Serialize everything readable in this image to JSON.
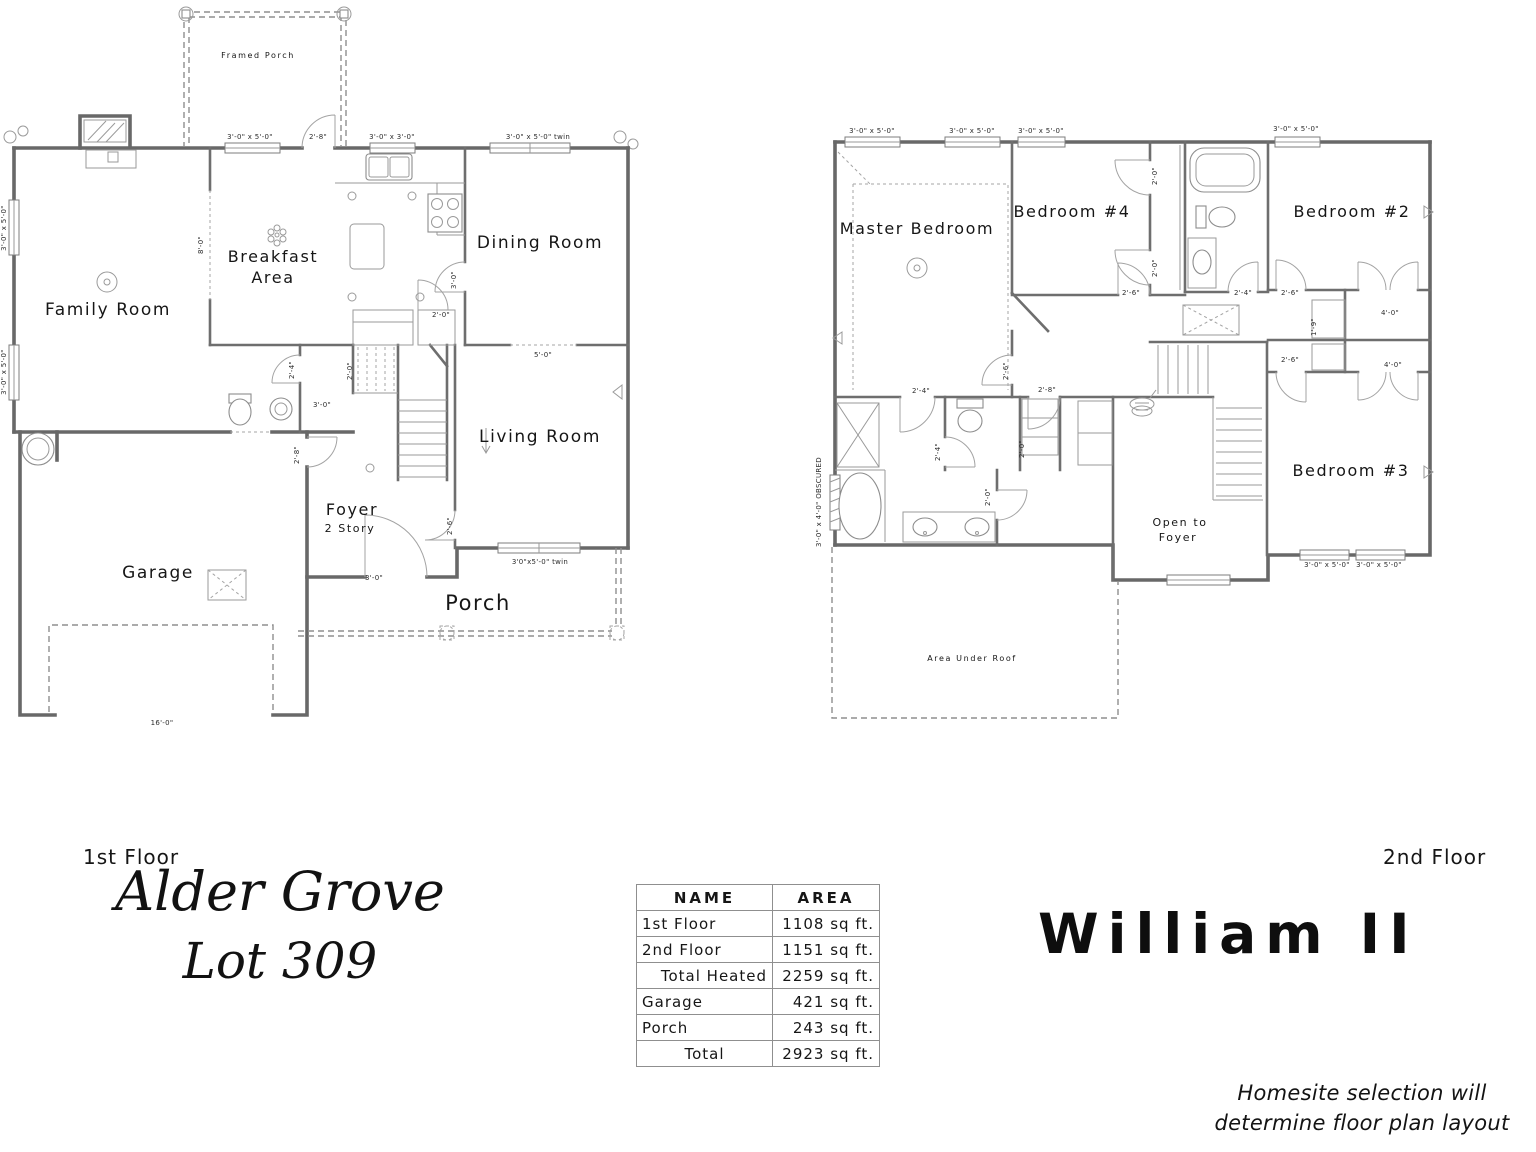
{
  "titles": {
    "first_floor_label": "1st Floor",
    "second_floor_label": "2nd Floor",
    "community_name": "Alder Grove",
    "lot_number": "Lot 309",
    "plan_name": "William II",
    "disclaimer_line1": "Homesite selection will",
    "disclaimer_line2": "determine floor plan layout"
  },
  "colors": {
    "wall": "#686868",
    "text": "#161616",
    "background": "#ffffff"
  },
  "area_table": {
    "name_header": "NAME",
    "area_header": "AREA",
    "rows": [
      {
        "name": "1st Floor",
        "area": "1108 sq ft."
      },
      {
        "name": "2nd Floor",
        "area": "1151 sq ft."
      },
      {
        "name": "Total Heated",
        "area": "2259 sq ft."
      },
      {
        "name": "Garage",
        "area": "421 sq ft."
      },
      {
        "name": "Porch",
        "area": "243 sq ft."
      },
      {
        "name": "Total",
        "area": "2923 sq ft."
      }
    ]
  },
  "floor1": {
    "rooms": {
      "family": "Family Room",
      "breakfast1": "Breakfast",
      "breakfast2": "Area",
      "dining": "Dining Room",
      "living": "Living Room",
      "foyer": "Foyer",
      "foyer_sub": "2 Story",
      "garage": "Garage",
      "porch": "Porch",
      "framed_porch": "Framed Porch"
    },
    "dims": [
      {
        "t": "3'-0\" x 5'-0\"",
        "x": 250,
        "y": 139
      },
      {
        "t": "2'-8\"",
        "x": 318,
        "y": 139
      },
      {
        "t": "3'-0\" x 3'-0\"",
        "x": 392,
        "y": 139
      },
      {
        "t": "3'-0\" x 5'-0\" twin",
        "x": 538,
        "y": 139
      },
      {
        "t": "3'-0\" x 5'-0\"",
        "x": 6,
        "y": 228,
        "r": -90
      },
      {
        "t": "3'-0\" x 5'-0\"",
        "x": 6,
        "y": 372,
        "r": -90
      },
      {
        "t": "8'-0\"",
        "x": 203,
        "y": 245,
        "r": -90
      },
      {
        "t": "2'-4\"",
        "x": 294,
        "y": 370,
        "r": -90
      },
      {
        "t": "3'-0\"",
        "x": 322,
        "y": 407
      },
      {
        "t": "2'-0\"",
        "x": 352,
        "y": 371,
        "r": -90
      },
      {
        "t": "3'-0\"",
        "x": 456,
        "y": 280,
        "r": -90
      },
      {
        "t": "2'-0\"",
        "x": 441,
        "y": 317
      },
      {
        "t": "5'-0\"",
        "x": 543,
        "y": 357
      },
      {
        "t": "2'-8\"",
        "x": 299,
        "y": 455,
        "r": -90
      },
      {
        "t": "2'-6\"",
        "x": 452,
        "y": 526,
        "r": -90
      },
      {
        "t": "3'-0\"",
        "x": 374,
        "y": 580
      },
      {
        "t": "3'0\"x5'-0\" twin",
        "x": 540,
        "y": 564
      },
      {
        "t": "16'-0\"",
        "x": 162,
        "y": 725
      }
    ]
  },
  "floor2": {
    "rooms": {
      "master": "Master Bedroom",
      "bed4": "Bedroom #4",
      "bed2": "Bedroom #2",
      "bed3": "Bedroom #3",
      "open1": "Open to",
      "open2": "Foyer",
      "area_under_roof": "Area Under Roof"
    },
    "dims": [
      {
        "t": "3'-0\" x 5'-0\"",
        "x": 872,
        "y": 133
      },
      {
        "t": "3'-0\" x 5'-0\"",
        "x": 972,
        "y": 133
      },
      {
        "t": "3'-0\" x 5'-0\"",
        "x": 1041,
        "y": 133
      },
      {
        "t": "3'-0\" x 5'-0\"",
        "x": 1296,
        "y": 131
      },
      {
        "t": "2'-0\"",
        "x": 1157,
        "y": 176,
        "r": -90
      },
      {
        "t": "2'-0\"",
        "x": 1157,
        "y": 268,
        "r": -90
      },
      {
        "t": "2'-6\"",
        "x": 1131,
        "y": 295
      },
      {
        "t": "2'-4\"",
        "x": 1243,
        "y": 295
      },
      {
        "t": "2'-6\"",
        "x": 1290,
        "y": 295
      },
      {
        "t": "1'-9\"",
        "x": 1316,
        "y": 327,
        "r": -90
      },
      {
        "t": "4'-0\"",
        "x": 1390,
        "y": 315
      },
      {
        "t": "2'-6\"",
        "x": 1290,
        "y": 362
      },
      {
        "t": "4'-0\"",
        "x": 1393,
        "y": 367
      },
      {
        "t": "2'-6\"",
        "x": 1008,
        "y": 371,
        "r": -90
      },
      {
        "t": "2'-4\"",
        "x": 921,
        "y": 393
      },
      {
        "t": "2'-8\"",
        "x": 1047,
        "y": 392
      },
      {
        "t": "2'-4\"",
        "x": 940,
        "y": 452,
        "r": -90
      },
      {
        "t": "2'-0\"",
        "x": 1024,
        "y": 449,
        "r": -90
      },
      {
        "t": "2'-0\"",
        "x": 990,
        "y": 497,
        "r": -90
      },
      {
        "t": "3'-0\" x 4'-0\" OBSCURED",
        "x": 821,
        "y": 502,
        "r": -90
      },
      {
        "t": "3'-0\" x 5'-0\"",
        "x": 1327,
        "y": 567
      },
      {
        "t": "3'-0\" x 5'-0\"",
        "x": 1379,
        "y": 567
      }
    ]
  }
}
